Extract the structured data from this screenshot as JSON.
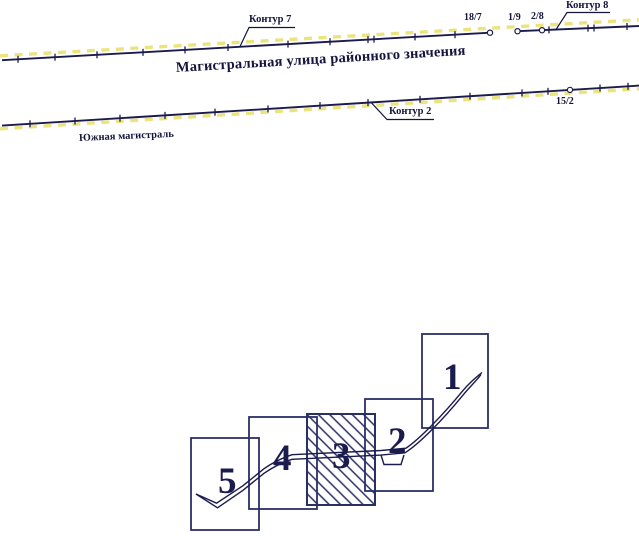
{
  "map": {
    "street_name": "Магистральная улица районного значения",
    "south_highway": "Южная магистраль",
    "contour_7": "Контур 7",
    "contour_8": "Контур 8",
    "contour_2": "Контур 2",
    "points": {
      "p18_7": "18/7",
      "p1_9": "1/9",
      "p2_8": "2/8",
      "p15_2": "15/2"
    }
  },
  "sheet_scheme": {
    "sheets": [
      {
        "label": "1",
        "hatched": false
      },
      {
        "label": "2",
        "hatched": false
      },
      {
        "label": "3",
        "hatched": true
      },
      {
        "label": "4",
        "hatched": false
      },
      {
        "label": "5",
        "hatched": false
      }
    ]
  },
  "colors": {
    "ink": "#1b1b4e",
    "line": "#14143c",
    "highlight": "#ece37f",
    "background": "#ffffff"
  }
}
